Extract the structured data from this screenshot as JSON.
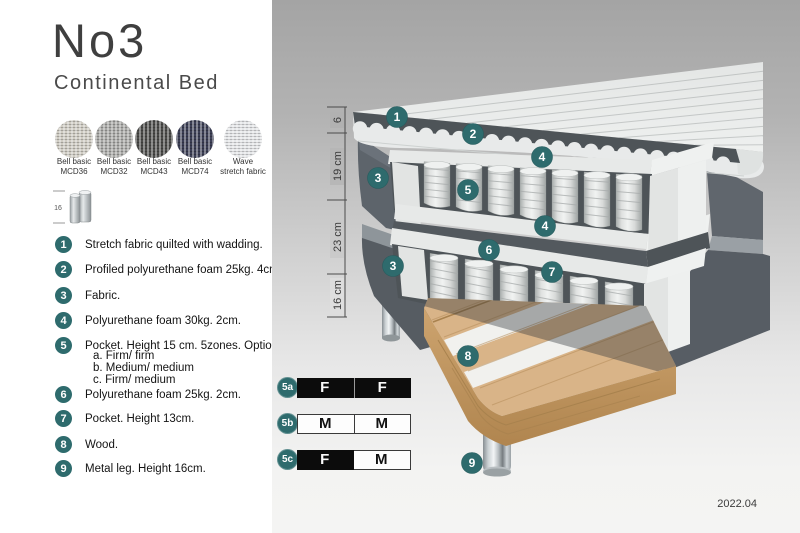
{
  "header": {
    "title": "No3",
    "subtitle": "Continental Bed"
  },
  "swatches": [
    {
      "label_line1": "Bell basic",
      "label_line2": "MCD36",
      "color": "#cfccc3"
    },
    {
      "label_line1": "Bell basic",
      "label_line2": "MCD32",
      "color": "#a9a9a7"
    },
    {
      "label_line1": "Bell basic",
      "label_line2": "MCD43",
      "color": "#4c4c4a"
    },
    {
      "label_line1": "Bell basic",
      "label_line2": "MCD74",
      "color": "#3c3f55"
    },
    {
      "label_line1": "Wave",
      "label_line2": "stretch fabric",
      "color": "#e5e7e9"
    }
  ],
  "leg_thumbnail": {
    "dimension_label": "16"
  },
  "spec_list": [
    {
      "num": "1",
      "text": "Stretch fabric quilted with wadding."
    },
    {
      "num": "2",
      "text": "Profiled polyurethane foam 25kg. 4cm."
    },
    {
      "num": "3",
      "text": "Fabric."
    },
    {
      "num": "4",
      "text": "Polyurethane foam 30kg. 2cm."
    },
    {
      "num": "5",
      "text": "Pocket. Height 15 cm. 5zones. Option:",
      "options": [
        "a. Firm/ firm",
        "b. Medium/ medium",
        "c. Firm/ medium"
      ]
    },
    {
      "num": "6",
      "text": "Polyurethane foam 25kg. 2cm."
    },
    {
      "num": "7",
      "text": "Pocket. Height 13cm."
    },
    {
      "num": "8",
      "text": "Wood."
    },
    {
      "num": "9",
      "text": "Metal leg. Height 16cm."
    }
  ],
  "diagram": {
    "ruler_labels": [
      "6",
      "19 cm",
      "23 cm",
      "16 cm"
    ],
    "markers": [
      "1",
      "2",
      "4",
      "3",
      "5",
      "4",
      "6",
      "3",
      "7",
      "8",
      "9"
    ],
    "firmness_options": [
      {
        "id": "5a",
        "left_label": "F",
        "right_label": "F",
        "left_fill": "black",
        "right_fill": "black"
      },
      {
        "id": "5b",
        "left_label": "M",
        "right_label": "M",
        "left_fill": "white",
        "right_fill": "white"
      },
      {
        "id": "5c",
        "left_label": "F",
        "right_label": "M",
        "left_fill": "black",
        "right_fill": "white"
      }
    ],
    "version": "2022.04",
    "colors": {
      "marker_teal": "#2e6b6d",
      "dark_fabric": "#5d646b",
      "wood": "#d9b488",
      "chrome": "#c7cdd0",
      "panel_top": "#a4a4a4",
      "panel_bottom": "#f4f4f3"
    }
  }
}
